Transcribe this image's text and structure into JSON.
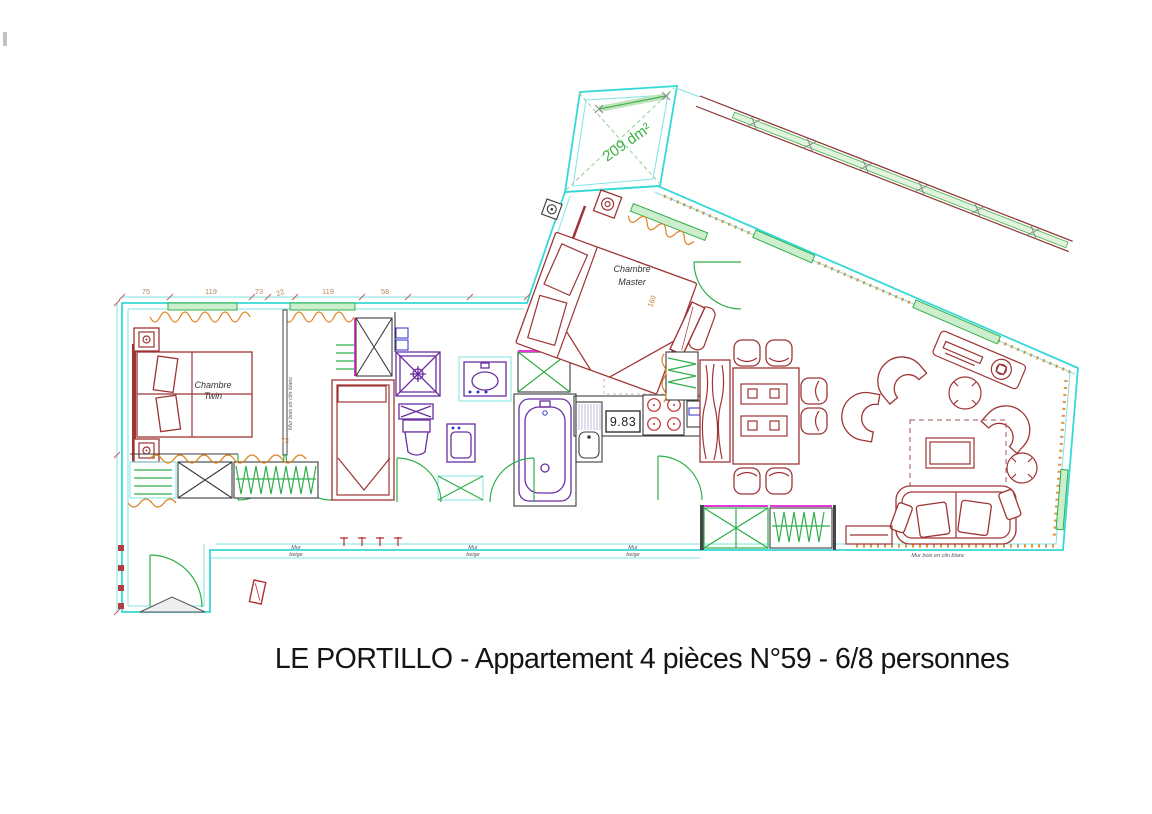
{
  "title": "LE PORTILLO - Appartement 4 pièces N°59 - 6/8 personnes",
  "balcony": {
    "area_label": "209 dm²"
  },
  "rooms": {
    "twin": {
      "name_line1": "Chambre",
      "name_line2": "Twin"
    },
    "master": {
      "name_line1": "Chambre",
      "name_line2": "Master",
      "bed_width_cm": "160"
    }
  },
  "kitchen": {
    "meter_reading": "9.83"
  },
  "dimensions": {
    "top_chain": [
      "75",
      "119",
      "73",
      "22",
      "119",
      "58"
    ],
    "wall_marker": "73"
  },
  "wall_labels": {
    "mur_beige_line1": "Mur",
    "mur_beige_line2": "beige",
    "wood_clad": "Mur bois en clin blanc"
  },
  "colors": {
    "envelope_cyan": "#35d8d8",
    "joinery_green": "#2eaf4b",
    "furniture_red": "#9e3434",
    "radiator_orange": "#e2801e",
    "sanitary_purple": "#6a2ea0",
    "accent_magenta": "#e138d6",
    "area_text_green": "#3cb043",
    "dimension_text": "#b5895f"
  }
}
